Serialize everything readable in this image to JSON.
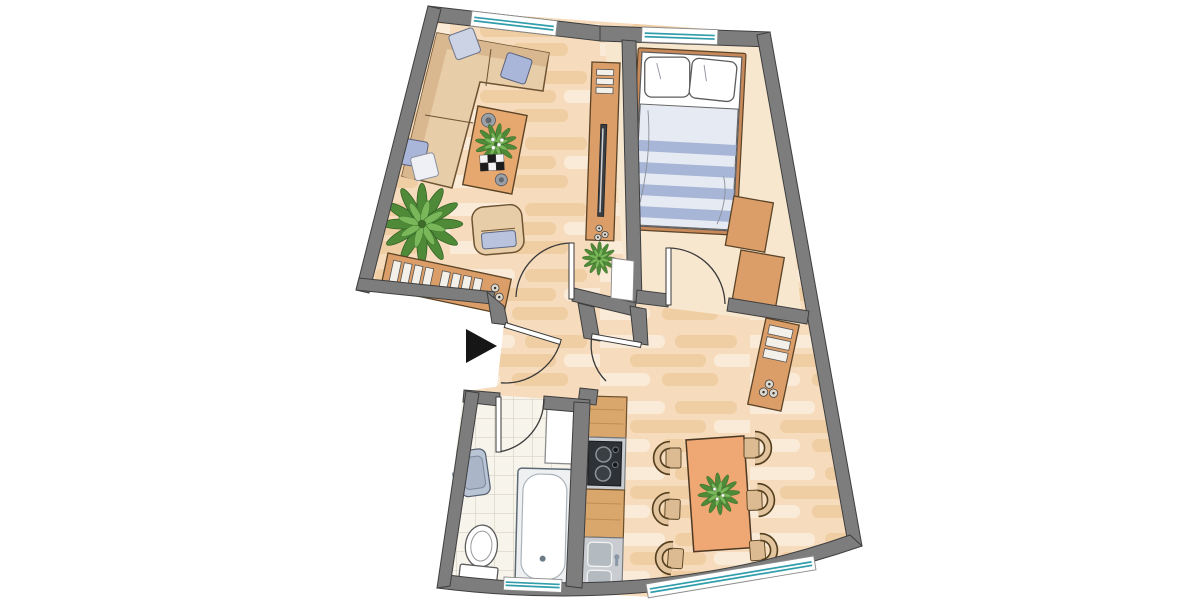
{
  "image": {
    "type": "apartment-floor-plan",
    "viewBox": "0 0 1200 600",
    "width": 1200,
    "height": 600
  },
  "colors": {
    "bg": "#ffffff",
    "wall": "#7d7d7d",
    "wall_line": "#3f3f3f",
    "line": "#3a3a3a",
    "plank_base": "#f6dcbc",
    "plank_light": "#fbeedd",
    "plank_dark": "#efcb9e",
    "bedroom_floor": "#f8e7cf",
    "tile_base": "#f7f4ec",
    "tile_line": "#d8d2c4",
    "furn_wood": "#dc9e68",
    "furn_wood_dark": "#5a4326",
    "counter_wood": "#d9a76b",
    "coffee_table": "#e7a870",
    "dining_table": "#efa873",
    "sofa": "#e8cda9",
    "sofa_dark": "#d9b890",
    "sofa_line": "#6f5433",
    "pillow_blue": "#a9b6da",
    "pillow_pale": "#ccd3e4",
    "pillow_white": "#eef0f6",
    "seat_blue": "#b9c3de",
    "leaf_dark": "#4f8a38",
    "leaf_light": "#7ab65a",
    "glass": "#2f9dab",
    "window_frame": "#8a8a8a",
    "metal_gray": "#c9cdd2",
    "basin": "#b3bac0",
    "cooktop": "#2e3236",
    "tv_screen": "#3a3d41",
    "bed_frame": "#c8895a",
    "duvet_blue": "#a7b5d6",
    "duvet_pale": "#e6eaf3",
    "fixture_white": "#ffffff",
    "fixture_line": "#5c5c5c",
    "sink_blue": "#b9c4d4",
    "slat": "#f3f0e9",
    "marker_black": "#161616"
  },
  "rooms": [
    {
      "id": "living-room",
      "floor": "wood-parquet",
      "furniture": [
        "corner-sofa",
        "sofa-pillows",
        "coffee-table",
        "potted-plant",
        "armchair",
        "sideboard",
        "tv-board",
        "tv"
      ]
    },
    {
      "id": "bedroom",
      "floor": "plain",
      "furniture": [
        "double-bed",
        "pillows",
        "striped-duvet",
        "wardrobe-2-sections"
      ]
    },
    {
      "id": "hallway",
      "floor": "wood-parquet",
      "furniture": []
    },
    {
      "id": "bathroom",
      "floor": "tile",
      "furniture": [
        "washbasin",
        "toilet",
        "bathtub",
        "washing-machine"
      ]
    },
    {
      "id": "kitchen-dining",
      "floor": "wood-parquet",
      "furniture": [
        "kitchen-cabinet",
        "cooktop-4-burners",
        "kitchen-sink-2-basins",
        "dining-table",
        "six-chairs",
        "table-plant",
        "sideboard"
      ]
    }
  ],
  "openings": {
    "windows": [
      "living-room-top",
      "bedroom-top",
      "bathroom-bottom",
      "dining-bottom"
    ],
    "doors": [
      "entrance",
      "living-room",
      "bedroom",
      "bathroom",
      "hall-to-dining"
    ],
    "entrance_marker": "black-triangle-arrow"
  }
}
